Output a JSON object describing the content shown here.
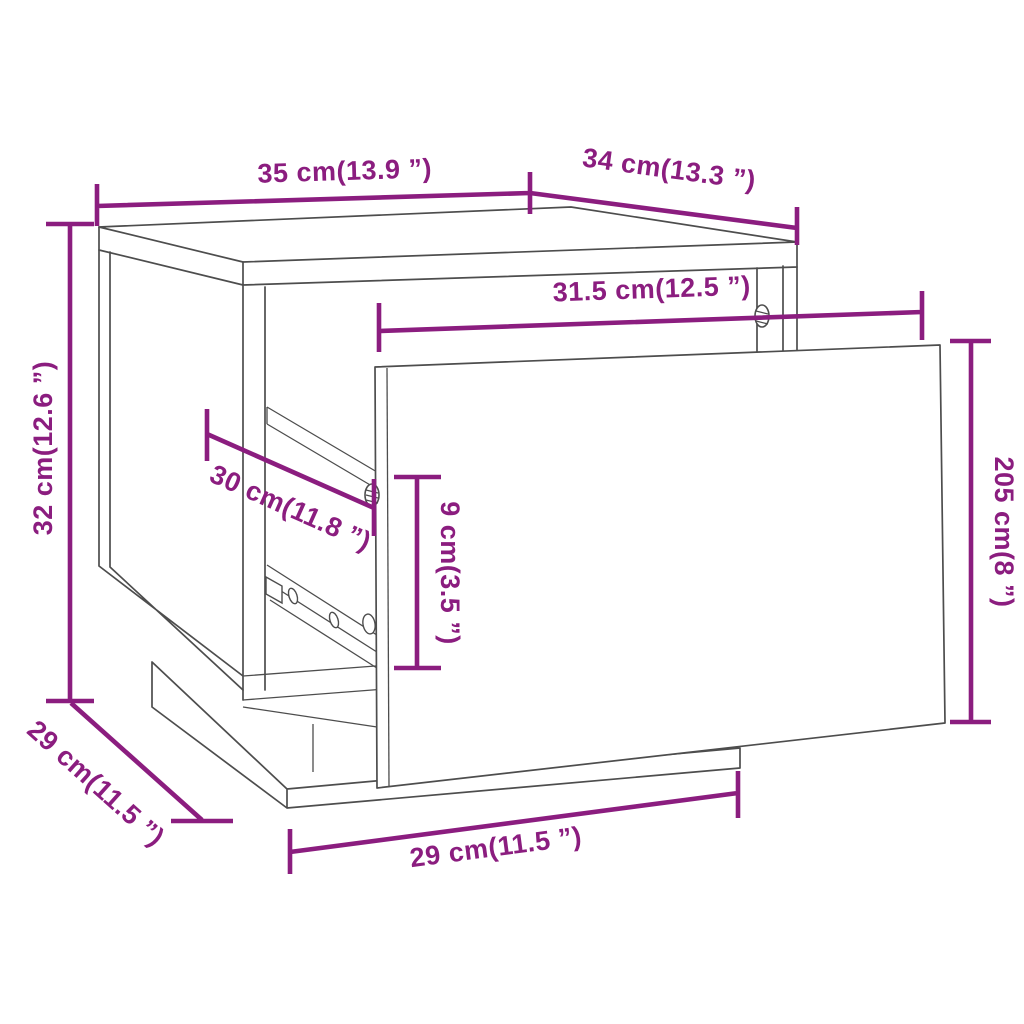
{
  "colors": {
    "dimension_accent": "#8B1D7F",
    "line_art": "#4d4d4d",
    "background": "#ffffff"
  },
  "dims": {
    "top_width": {
      "label": "35 cm(13.9 ”)"
    },
    "top_depth": {
      "label": "34 cm(13.3 ”)"
    },
    "inner_width": {
      "label": "31.5 cm(12.5 ”)"
    },
    "height": {
      "label": "32 cm(12.6 ”)"
    },
    "runner_depth": {
      "label": "30 cm(11.8 ”)"
    },
    "drawer_gap_height": {
      "label": "9 cm(3.5 ”)"
    },
    "drawer_front_height": {
      "label": "205 cm(8 ”)"
    },
    "base_depth": {
      "label": "29 cm(11.5 ”)"
    },
    "base_width": {
      "label": "29 cm(11.5 ”)"
    }
  }
}
